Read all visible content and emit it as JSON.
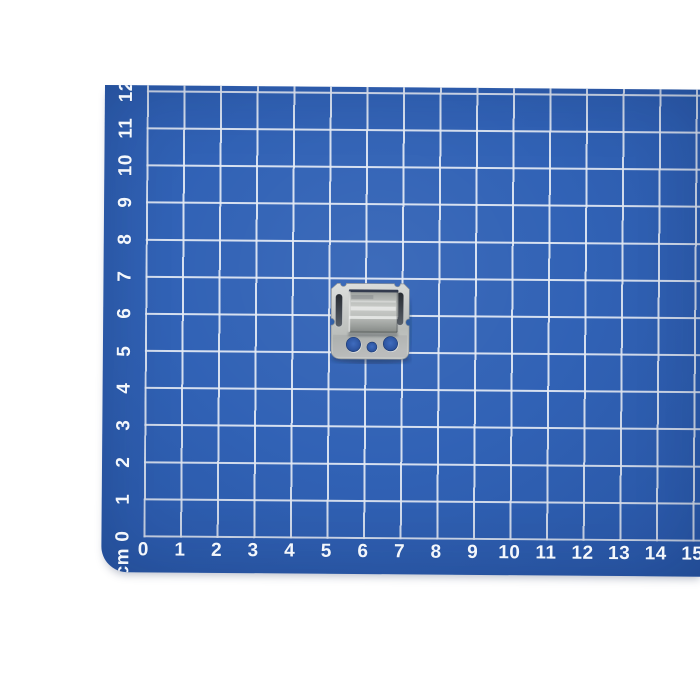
{
  "scene": {
    "description": "Small galvanized steel mounting clip photographed on a blue cutting mat with a white 1 cm grid",
    "background_color": "#ffffff"
  },
  "mat": {
    "surface_color": "#2d5fb4",
    "grid_line_color": "#e3eaf5",
    "label_color": "#f3f7fc",
    "unit_label": "cm",
    "cell_size_cm": "1",
    "bottom_ruler_labels": [
      "0",
      "1",
      "2",
      "3",
      "4",
      "5",
      "6",
      "7",
      "8",
      "9",
      "10",
      "11",
      "12",
      "13",
      "14",
      "15"
    ],
    "left_ruler_labels": [
      "0",
      "1",
      "2",
      "3",
      "4",
      "5",
      "6",
      "7",
      "8",
      "9",
      "10",
      "11",
      "12"
    ]
  },
  "object": {
    "name": "galvanized metal clip",
    "approx_size": "2 cm x 2 cm",
    "grid_position": "centered near 6 cm horizontal, 6 cm vertical",
    "metal_color": "#c6c8c6",
    "bridge_front_color": "#999d9a",
    "slot_color": "#3c4149",
    "hole_color": "#2d54a0",
    "features": "raised rectangular bridge, two vertical side slots, two large round holes, one small round hole"
  }
}
